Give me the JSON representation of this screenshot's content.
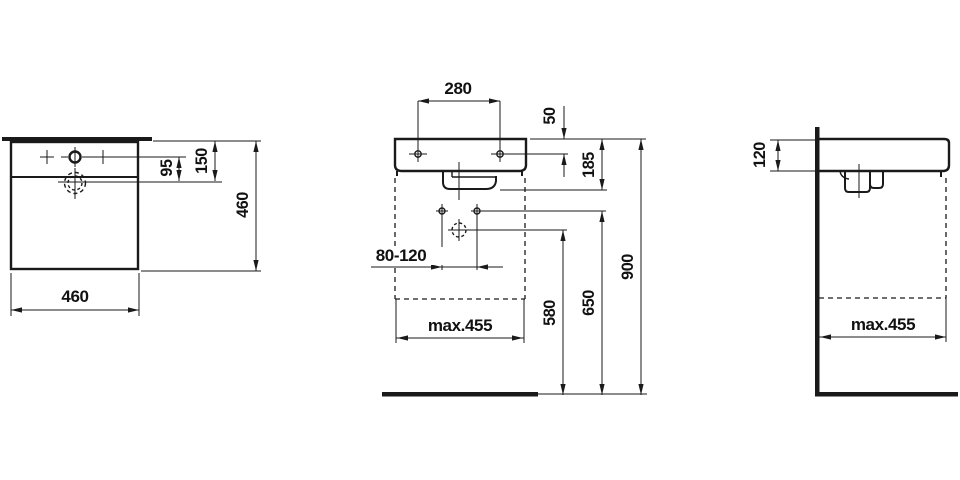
{
  "drawing": {
    "colors": {
      "line": "#1a1a1a",
      "text": "#111111",
      "background": "#ffffff"
    },
    "views": {
      "top": {
        "dim_faucet_to_drain": "95",
        "dim_rear_to_drain": "150",
        "dim_depth": "460",
        "dim_width": "460"
      },
      "front": {
        "dim_taphole_spacing": "280",
        "dim_top_to_holes": "50",
        "dim_body_height": "185",
        "dim_bolt_spacing": "80-120",
        "dim_max_clearance_width": "max.455",
        "dim_trap_height": "580",
        "dim_bolt_height": "650",
        "dim_rim_height": "900"
      },
      "side": {
        "dim_body_thickness": "120",
        "dim_max_clearance_depth": "max.455"
      }
    }
  }
}
